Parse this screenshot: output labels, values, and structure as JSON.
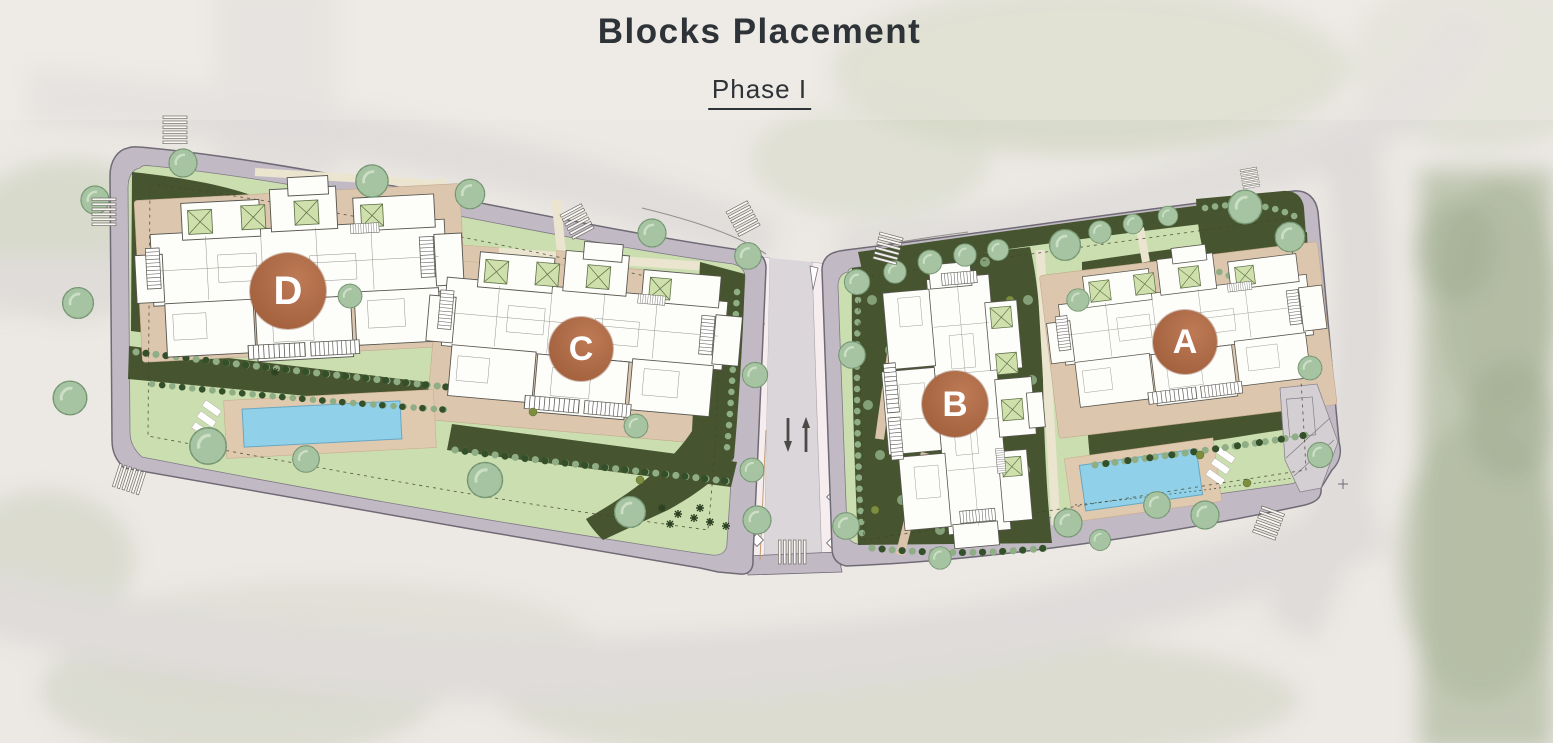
{
  "header": {
    "title": "Blocks Placement",
    "subtitle": "Phase I"
  },
  "plan": {
    "blocks": [
      {
        "label": "D"
      },
      {
        "label": "C"
      },
      {
        "label": "B"
      },
      {
        "label": "A"
      }
    ],
    "features": {
      "parcels": 2,
      "pools": 2
    },
    "colors": {
      "block_marker": "#ac6a49",
      "block_letter": "#ffffff",
      "lawn": "#cbdeb0",
      "dense_planting": "#46552f",
      "paving": "#dcc7ae",
      "pool_water": "#90d1e9",
      "sidewalk": "#c1bac4",
      "road": "#dad6d9",
      "title_text": "#2e3338"
    }
  }
}
